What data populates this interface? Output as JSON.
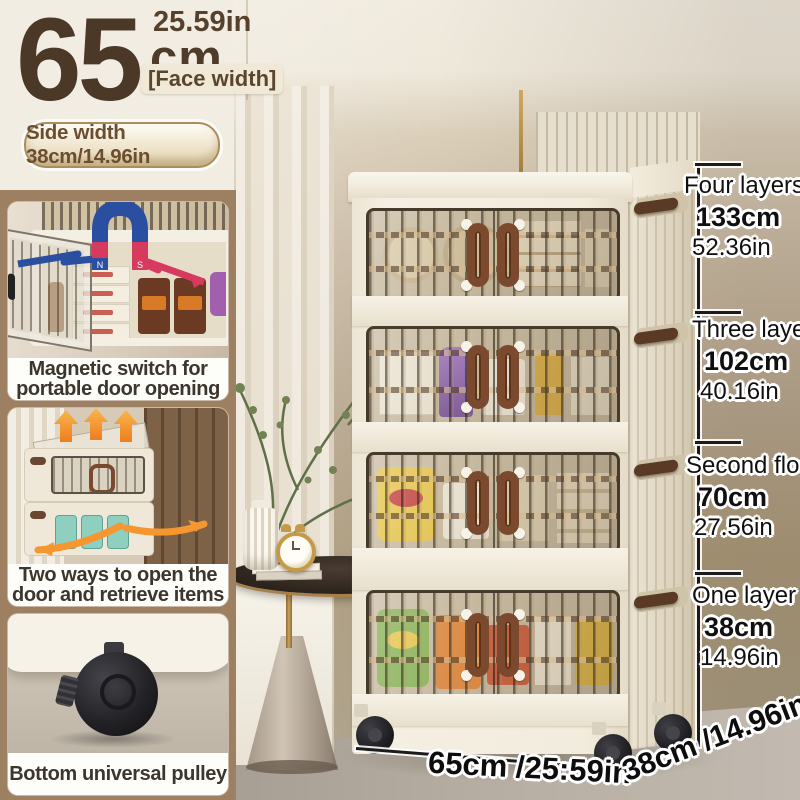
{
  "header": {
    "width_value": "65",
    "width_unit": "cm",
    "width_inches": "25.59in",
    "face_width_label": "[Face width]",
    "side_width_badge": "Side width 38cm/14.96in"
  },
  "features": [
    {
      "line1": "Magnetic switch for",
      "line2": "portable door opening"
    },
    {
      "line1": "Two ways to open the",
      "line2": "door and retrieve items"
    },
    {
      "line1": "Bottom universal pulley",
      "line2": ""
    }
  ],
  "measurements": [
    {
      "label": "Four layers",
      "cm": "133cm",
      "inches": "52.36in"
    },
    {
      "label": "Three layers",
      "cm": "102cm",
      "inches": "40.16in"
    },
    {
      "label": "Second floor",
      "cm": "70cm",
      "inches": "27.56in"
    },
    {
      "label": "One layer",
      "cm": "38cm",
      "inches": "14.96in"
    }
  ],
  "bottom_dimensions": {
    "width": "65cm /25:59in",
    "depth": "38cm /14.96in"
  },
  "icons": {
    "magnet": "magnet-icon",
    "lift_arrows": "up-arrows-icon",
    "open_arrows": "curved-arrows-icon",
    "caster": "caster-wheel-icon"
  },
  "colors": {
    "accent_brown": "#4b3827",
    "panel_brown": "#9d7f61",
    "magnet_blue": "#2b4fa0",
    "magnet_red": "#d63a5e",
    "arrow_orange": "#f5962f",
    "handle_brown": "#7b4a2e",
    "cream": "#f2ede3"
  }
}
